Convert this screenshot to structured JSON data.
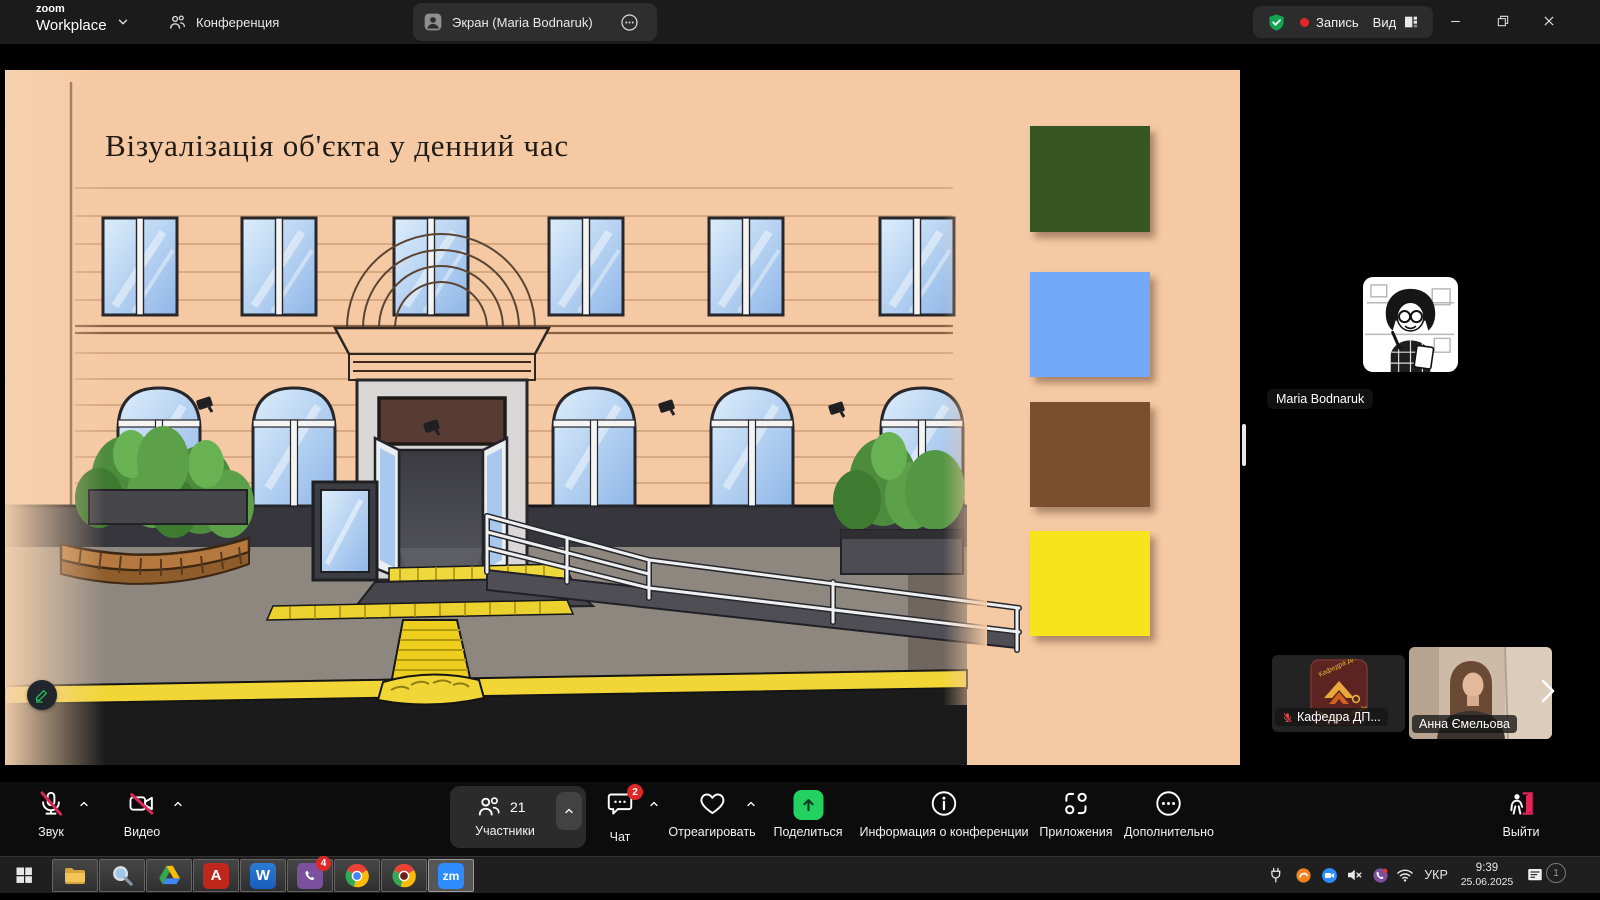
{
  "top_bar": {
    "logo_line1": "zoom",
    "logo_line2": "Workplace",
    "tab_meeting": "Конференция",
    "tab_screen": "Экран (Maria Bodnaruk)",
    "recording_label": "Запись",
    "view_label": "Вид"
  },
  "slide": {
    "title": "Візуалізація об'єкта у денний час",
    "palette": [
      {
        "name": "green",
        "hex": "#375623"
      },
      {
        "name": "blue",
        "hex": "#74a9f7"
      },
      {
        "name": "brown",
        "hex": "#7b4f2e"
      },
      {
        "name": "yellow",
        "hex": "#f8e41c"
      }
    ]
  },
  "participants_panel": {
    "speaker_name": "Maria Bodnaruk",
    "thumbnails": [
      {
        "name": "Кафедра ДП...",
        "muted": true,
        "logo_text": "Кафедра ДПМ",
        "logo_subtext": "та дизайн"
      },
      {
        "name": "Анна Ємельова",
        "muted": false
      }
    ]
  },
  "toolbar": {
    "audio_label": "Звук",
    "video_label": "Видео",
    "participants_label": "Участники",
    "participants_count": "21",
    "chat_label": "Чат",
    "chat_badge": "2",
    "react_label": "Отреагировать",
    "share_label": "Поделиться",
    "info_label": "Информация о конференции",
    "apps_label": "Приложения",
    "more_label": "Дополнительно",
    "leave_label": "Выйти"
  },
  "taskbar": {
    "word_letter": "W",
    "acrobat_letter": "A",
    "zoom_letter": "zm",
    "viber_badge": "4",
    "language": "УКР",
    "time": "9:39",
    "date": "25.06.2025",
    "notification_count": "1"
  },
  "theme": {
    "danger_red": "#e0255a",
    "record_red": "#e02828",
    "shield_green": "#13a351",
    "share_green": "#23d160",
    "zoom_blue": "#2d8cff",
    "slide_background": "#f5c9a3"
  }
}
